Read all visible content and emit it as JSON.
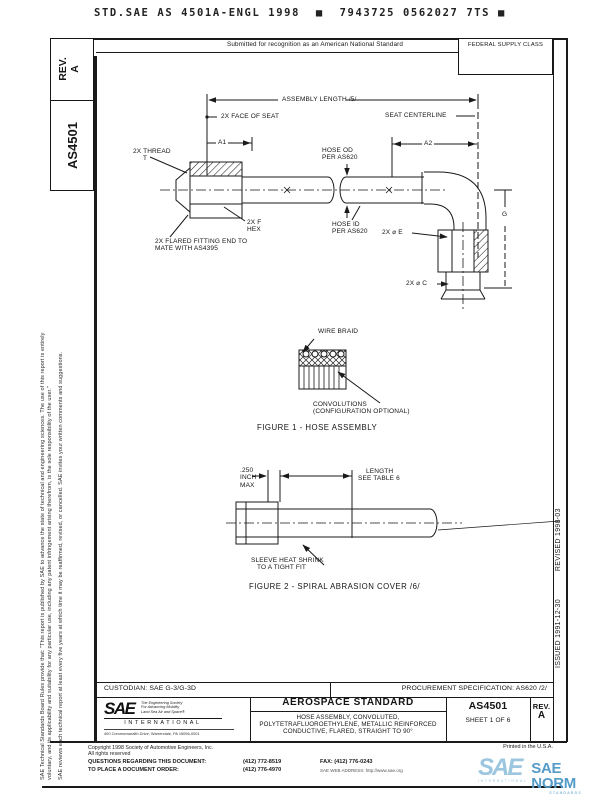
{
  "header": {
    "top_code": "STD.SAE AS 4501A-ENGL 1998  ■  7943725 0562027 7TS ■",
    "submitted": "Submitted for recognition as an American National Standard",
    "federal_supply_class": "FEDERAL SUPPLY CLASS"
  },
  "sidebar_left": {
    "rev_label": "REV.",
    "rev_value": "A",
    "doc_number": "AS4501",
    "disclaimer_1": "SAE Technical Standards Board Rules provide that: \"This report is published by SAE to advance the state of technical and engineering sciences. The use of this report is entirely",
    "disclaimer_2": "voluntary, and its applicability and suitability for any particular use, including any patent infringement arising therefrom, is the sole responsibility of the user.\"",
    "disclaimer_3": "SAE reviews each technical report at least every five years at which time it may be reaffirmed, revised, or cancelled. SAE invites your written comments and suggestions."
  },
  "sidebar_right": {
    "issued": "ISSUED 1991-12-30",
    "revised": "REVISED 1998-03"
  },
  "figure1": {
    "assembly_length": "ASSEMBLY LENGTH /5/",
    "face_of_seat": "2X FACE OF SEAT",
    "seat_centerline": "SEAT CENTERLINE",
    "a1": "A1",
    "a2": "A2",
    "hose_od_1": "HOSE OD",
    "hose_od_2": "PER AS620",
    "thread_1": "2X THREAD",
    "thread_2": "T",
    "hex_1": "2X F",
    "hex_2": "HEX",
    "hose_id_1": "HOSE ID",
    "hose_id_2": "PER AS620",
    "flared_1": "2X FLARED FITTING END TO",
    "flared_2": "MATE WITH AS4395",
    "dia_e": "2X ⌀ E",
    "dim_g": "G",
    "dia_c": "2X ⌀ C",
    "wire_braid": "WIRE BRAID",
    "convolutions_1": "CONVOLUTIONS",
    "convolutions_2": "(CONFIGURATION OPTIONAL)",
    "caption": "FIGURE 1 - HOSE ASSEMBLY"
  },
  "figure2": {
    "max_1": ".250",
    "max_2": "INCH",
    "max_3": "MAX",
    "length_1": "LENGTH",
    "length_2": "SEE TABLE 6",
    "sleeve_1": "SLEEVE HEAT SHRINK",
    "sleeve_2": "TO A TIGHT FIT",
    "caption": "FIGURE 2 - SPIRAL ABRASION COVER /6/"
  },
  "title_block": {
    "custodian": "CUSTODIAN:  SAE G-3/G-3D",
    "procurement": "PROCUREMENT SPECIFICATION:  AS620 /2/",
    "standard_type": "AEROSPACE STANDARD",
    "title_line1": "HOSE ASSEMBLY, CONVOLUTED,",
    "title_line2": "POLYTETRAFLUOROETHYLENE, METALLIC REINFORCED",
    "title_line3": "CONDUCTIVE, FLARED, STRAIGHT TO 90°",
    "doc_number": "AS4501",
    "sheet": "SHEET 1 OF 6",
    "rev_label": "REV.",
    "rev_value": "A",
    "sae_logo": "SAE",
    "tagline_1": "The Engineering Society",
    "tagline_2": "For Advancing Mobility",
    "tagline_3": "Land Sea Air and Space®",
    "international": "INTERNATIONAL",
    "address": "400 Commonwealth Drive, Warrendale, PA 15096-0001"
  },
  "footer": {
    "printed": "Printed in the U.S.A.",
    "copyright_1": "Copyright 1998 Society of Automotive Engineers, Inc.",
    "copyright_2": "All rights reserved",
    "questions_label": "QUESTIONS REGARDING THIS DOCUMENT:",
    "questions_phone": "(412) 772-8519",
    "fax": "FAX: (412) 776-0243",
    "order_label": "TO PLACE A DOCUMENT ORDER:",
    "order_phone": "(412) 776-4970",
    "web": "SAE WEB ADDRESS: http://www.sae.org",
    "norm_sae": "SAE",
    "norm_intl": "INTERNATIONAL",
    "norm_name": "SAE NORM",
    "norm_sub": "STANDARDS"
  },
  "colors": {
    "line": "#1a1a1a",
    "norm_light_blue": "#9cc6e0",
    "norm_blue": "#549bc8"
  }
}
